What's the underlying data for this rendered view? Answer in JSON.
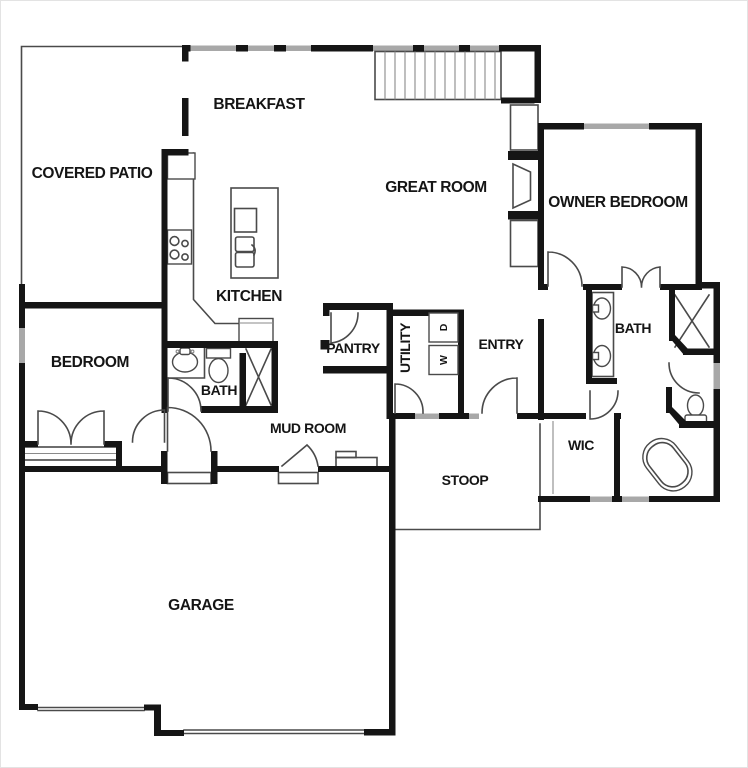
{
  "canvas": {
    "width": 748,
    "height": 768
  },
  "colors": {
    "wall": "#151515",
    "line": "#4a4a4a",
    "light_line": "#8a8a8a",
    "window": "#a8a8a8",
    "background": "#ffffff",
    "frame": "#e3e3e3",
    "label": "#151515"
  },
  "rooms": {
    "covered_patio": {
      "label": "COVERED PATIO"
    },
    "breakfast": {
      "label": "BREAKFAST"
    },
    "great_room": {
      "label": "GREAT ROOM"
    },
    "owner_bedroom": {
      "label": "OWNER BEDROOM"
    },
    "kitchen": {
      "label": "KITCHEN"
    },
    "pantry": {
      "label": "PANTRY"
    },
    "utility": {
      "label": "UTILITY"
    },
    "entry": {
      "label": "ENTRY"
    },
    "hall_bath": {
      "label": "BATH"
    },
    "owner_bath": {
      "label": "BATH"
    },
    "bedroom": {
      "label": "BEDROOM"
    },
    "mud_room": {
      "label": "MUD ROOM"
    },
    "stoop": {
      "label": "STOOP"
    },
    "wic": {
      "label": "WIC"
    },
    "garage": {
      "label": "GARAGE"
    }
  },
  "appliances": {
    "dryer": {
      "label": "D"
    },
    "washer": {
      "label": "W"
    }
  },
  "fixtures": {
    "stairs": "stairs",
    "fireplace": "fireplace",
    "kitchen_island": "kitchen-island",
    "island_sink": "double-basin-sink",
    "refrigerator": "refrigerator",
    "cooktop": "cooktop",
    "range": "range-oven",
    "hall_bath_sink": "sink",
    "hall_bath_toilet": "toilet",
    "hall_bath_shower": "shower",
    "owner_vanity": "double-sink-vanity",
    "owner_shower": "shower",
    "owner_toilet": "toilet",
    "owner_tub": "freestanding-tub",
    "mud_bench": "bench",
    "french_doors": "double-french-doors"
  }
}
